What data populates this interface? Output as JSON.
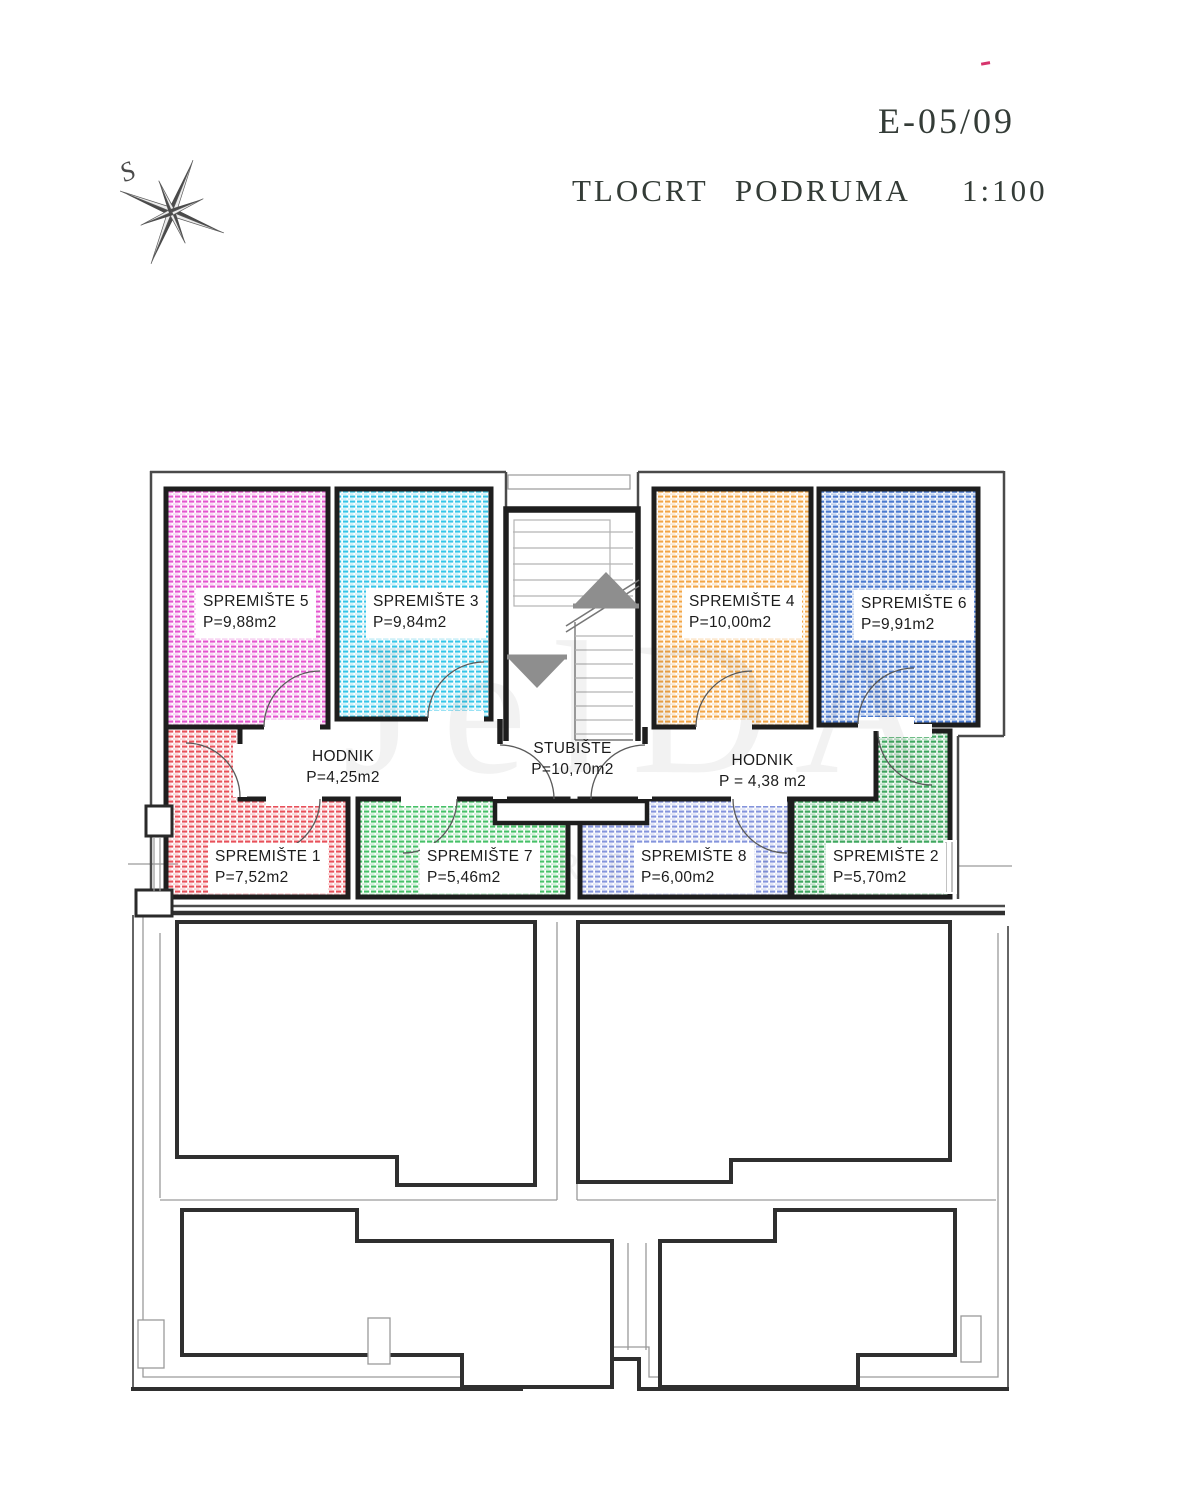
{
  "document": {
    "drawing_number": "E-05/09",
    "plan_title": "TLOCRT PODRUMA",
    "scale": "1:100"
  },
  "compass": {
    "north_label": "S"
  },
  "watermark": {
    "line1": "JelDA",
    "line2": "NEKRETNINE"
  },
  "colors": {
    "wall": "#1e1e1e",
    "outer_line": "#4a4a4a",
    "thin_line": "#9a9a9a",
    "lower_wall": "#2f2f2f",
    "stair_arrow": "#8e8e8e",
    "title_text": "#343c37",
    "red_mark": "#d6336c"
  },
  "rooms": [
    {
      "id": "spremiste5",
      "name": "SPREMIŠTE 5",
      "area": "P=9,88m2",
      "hatch": "#e455cf"
    },
    {
      "id": "spremiste3",
      "name": "SPREMIŠTE 3",
      "area": "P=9,84m2",
      "hatch": "#35c5e8"
    },
    {
      "id": "spremiste4",
      "name": "SPREMIŠTE 4",
      "area": "P=10,00m2",
      "hatch": "#f3a544"
    },
    {
      "id": "spremiste6",
      "name": "SPREMIŠTE 6",
      "area": "P=9,91m2",
      "hatch": "#4a79cf"
    },
    {
      "id": "spremiste1",
      "name": "SPREMIŠTE 1",
      "area": "P=7,52m2",
      "hatch": "#e8505a"
    },
    {
      "id": "spremiste7",
      "name": "SPREMIŠTE 7",
      "area": "P=5,46m2",
      "hatch": "#46c168"
    },
    {
      "id": "spremiste8",
      "name": "SPREMIŠTE 8",
      "area": "P=6,00m2",
      "hatch": "#8494dc"
    },
    {
      "id": "spremiste2",
      "name": "SPREMIŠTE 2",
      "area": "P=5,70m2",
      "hatch": "#3fa75f"
    }
  ],
  "zones": [
    {
      "id": "hodnik_left",
      "name": "HODNIK",
      "area": "P=4,25m2"
    },
    {
      "id": "stubiste",
      "name": "STUBIŠTE",
      "area": "P=10,70m2"
    },
    {
      "id": "hodnik_right",
      "name": "HODNIK",
      "area": "P = 4,38 m2"
    }
  ]
}
